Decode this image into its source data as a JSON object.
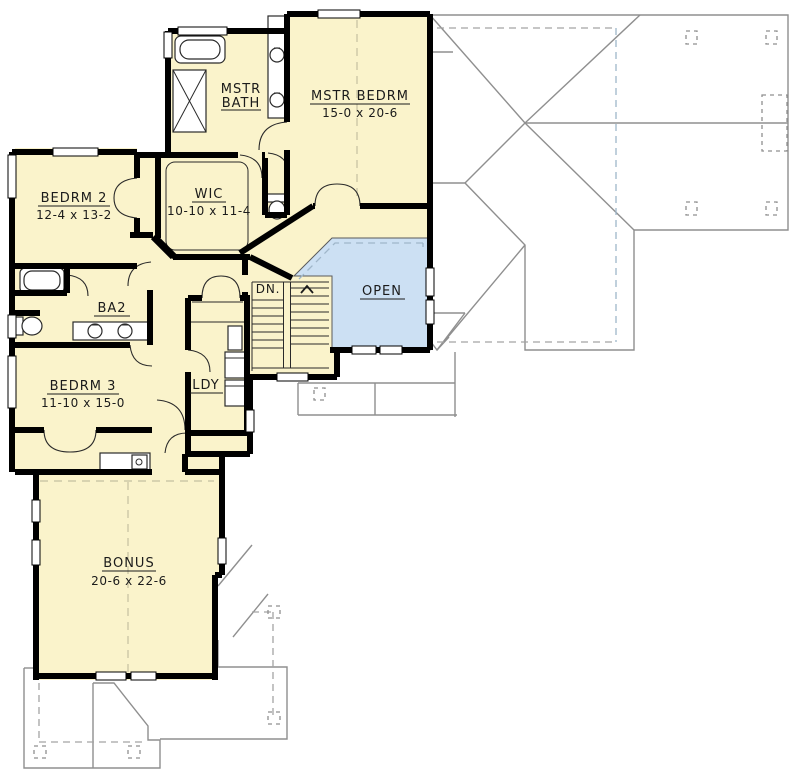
{
  "drawing": {
    "kind": "second-floor-plan",
    "colors": {
      "floor_fill": "#FAF3CB",
      "open_area_fill": "#CCE0F3",
      "wall": "#000000",
      "roof_line": "#8F8F8F",
      "background": "#FFFFFF"
    },
    "labels": {
      "mstr_bath_line1": "MSTR",
      "mstr_bath_line2": "BATH",
      "mstr_bedrm": "MSTR BEDRM",
      "mstr_bedrm_dims": "15-0 x 20-6",
      "bedrm2": "BEDRM 2",
      "bedrm2_dims": "12-4 x 13-2",
      "wic": "WIC",
      "wic_dims": "10-10 x 11-4",
      "ba2": "BA2",
      "bedrm3": "BEDRM 3",
      "bedrm3_dims": "11-10 x 15-0",
      "ldy": "LDY",
      "bonus": "BONUS",
      "bonus_dims": "20-6 x 22-6",
      "open": "OPEN",
      "stairs_down": "DN."
    },
    "rooms": [
      {
        "name": "MSTR BATH",
        "dims": ""
      },
      {
        "name": "MSTR BEDRM",
        "dims": "15-0 x 20-6"
      },
      {
        "name": "BEDRM 2",
        "dims": "12-4 x 13-2"
      },
      {
        "name": "WIC",
        "dims": "10-10 x 11-4"
      },
      {
        "name": "BA2",
        "dims": ""
      },
      {
        "name": "BEDRM 3",
        "dims": "11-10 x 15-0"
      },
      {
        "name": "LDY",
        "dims": ""
      },
      {
        "name": "BONUS",
        "dims": "20-6 x 22-6"
      },
      {
        "name": "OPEN",
        "dims": ""
      },
      {
        "name": "DN.",
        "dims": ""
      }
    ]
  }
}
